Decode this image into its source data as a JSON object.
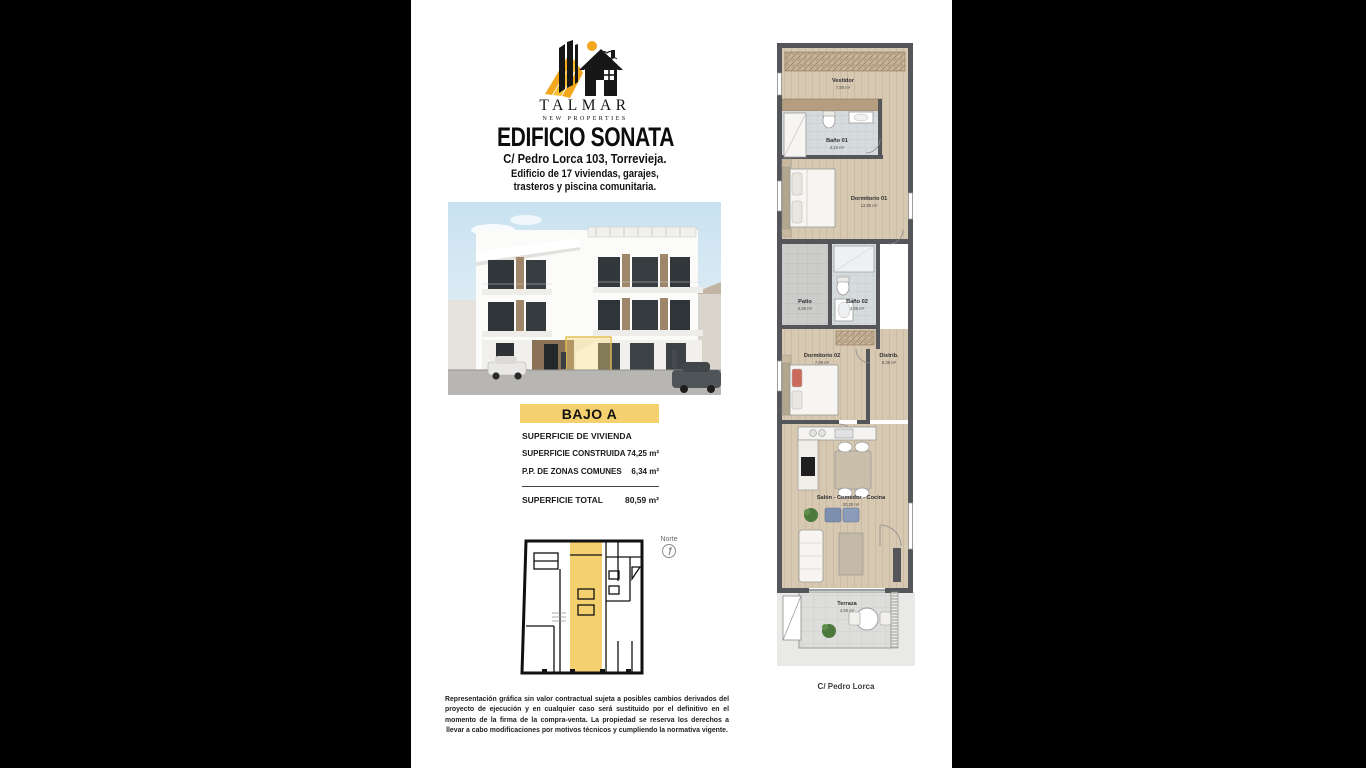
{
  "brand": {
    "name": "TALMAR",
    "tagline": "NEW PROPERTIES"
  },
  "header": {
    "title": "EDIFICIO SONATA",
    "address": "C/ Pedro Lorca 103, Torrevieja.",
    "description_line1": "Edificio de 17 viviendas, garajes,",
    "description_line2": "trasteros y piscina comunitaria."
  },
  "unit": {
    "label": "BAJO A"
  },
  "surface_table": {
    "header": "SUPERFICIE DE VIVIENDA",
    "rows": [
      {
        "label": "SUPERFICIE CONSTRUIDA",
        "value": "74,25 m²"
      },
      {
        "label": "P.P. DE ZONAS COMUNES",
        "value": "6,34 m²"
      }
    ],
    "total": {
      "label": "SUPERFICIE TOTAL",
      "value": "80,59 m²"
    }
  },
  "key_plan": {
    "north_label": "Norte"
  },
  "floor_plan": {
    "rooms": [
      {
        "name": "Vestidor",
        "area": "7,80 m²"
      },
      {
        "name": "Baño 01",
        "area": "4,10 m²"
      },
      {
        "name": "Dormitorio 01",
        "area": "12,80 m²"
      },
      {
        "name": "Patio",
        "area": "4,50 m²"
      },
      {
        "name": "Baño 02",
        "area": "3,35 m²"
      },
      {
        "name": "Dormitorio 02",
        "area": "7,00 m²"
      },
      {
        "name": "Distrib.",
        "area": "5,35 m²"
      },
      {
        "name": "Salón - Comedor - Cocina",
        "area": "20,30 m²"
      },
      {
        "name": "Terraza",
        "area": "4,50 m²"
      }
    ],
    "street_label": "C/ Pedro Lorca"
  },
  "disclaimer": "Representación gráfica sin valor contractual sujeta a posibles cambios derivados del proyecto de ejecución y en cualquier caso será sustituido por el definitivo en el momento de la firma de la compra-venta. La propiedad se reserva los derechos a llevar a cabo modificaciones por motivos técnicos y cumpliendo la normativa vigente.",
  "colors": {
    "accent_yellow": "#F5D06E",
    "logo_orange": "#F2A71C",
    "wall_gray": "#55565A"
  }
}
